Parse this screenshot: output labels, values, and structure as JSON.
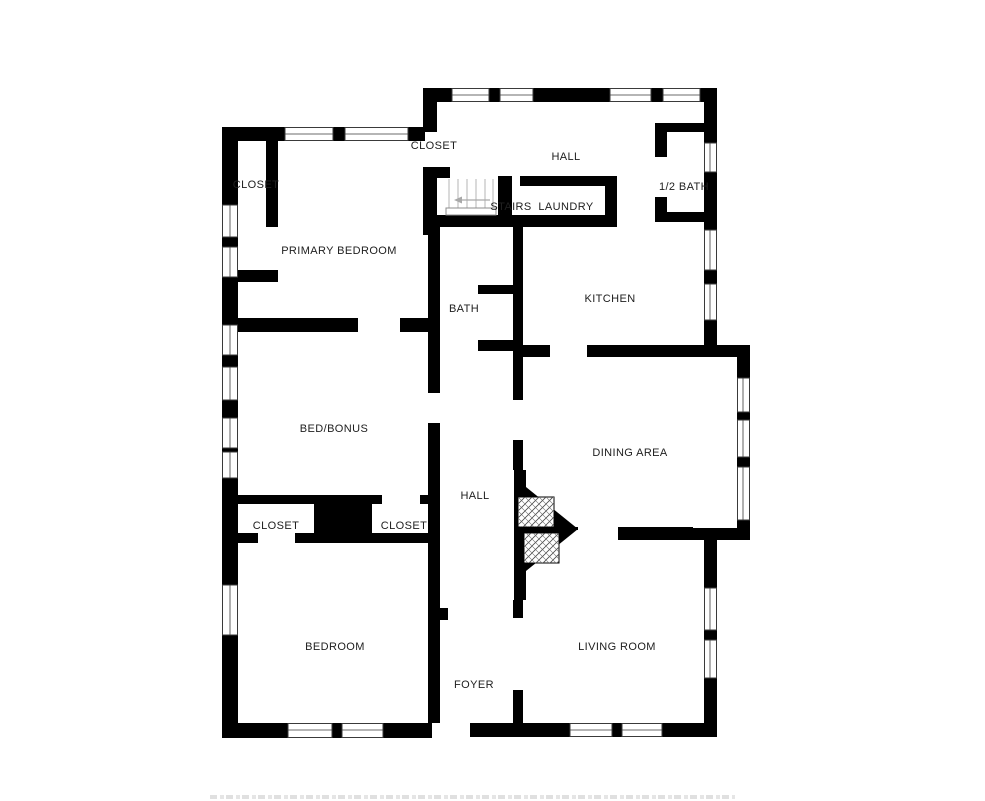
{
  "page": {
    "background_color": "#ffffff",
    "wall_color": "#000000",
    "label_color": "#202020"
  },
  "floorplan": {
    "type": "residential-floor-plan",
    "rooms": [
      {
        "id": "closet-primary",
        "label": "CLOSET",
        "x": 256,
        "y": 184
      },
      {
        "id": "closet-hall",
        "label": "CLOSET",
        "x": 434,
        "y": 145
      },
      {
        "id": "hall-upper",
        "label": "HALL",
        "x": 566,
        "y": 156
      },
      {
        "id": "half-bath",
        "label": "1/2 BATH",
        "x": 684,
        "y": 186
      },
      {
        "id": "stairs",
        "label": "STAIRS",
        "x": 511,
        "y": 206
      },
      {
        "id": "laundry",
        "label": "LAUNDRY",
        "x": 566,
        "y": 206
      },
      {
        "id": "primary-bedroom",
        "label": "PRIMARY BEDROOM",
        "x": 339,
        "y": 250
      },
      {
        "id": "kitchen",
        "label": "KITCHEN",
        "x": 610,
        "y": 298
      },
      {
        "id": "bath",
        "label": "BATH",
        "x": 464,
        "y": 308
      },
      {
        "id": "bed-bonus",
        "label": "BED/BONUS",
        "x": 334,
        "y": 428
      },
      {
        "id": "dining-area",
        "label": "DINING AREA",
        "x": 630,
        "y": 452
      },
      {
        "id": "hall-lower",
        "label": "HALL",
        "x": 475,
        "y": 495
      },
      {
        "id": "closet-left",
        "label": "CLOSET",
        "x": 276,
        "y": 525
      },
      {
        "id": "closet-right",
        "label": "CLOSET",
        "x": 404,
        "y": 525
      },
      {
        "id": "bedroom",
        "label": "BEDROOM",
        "x": 335,
        "y": 646
      },
      {
        "id": "living-room",
        "label": "LIVING ROOM",
        "x": 617,
        "y": 646
      },
      {
        "id": "foyer",
        "label": "FOYER",
        "x": 474,
        "y": 684
      }
    ]
  }
}
